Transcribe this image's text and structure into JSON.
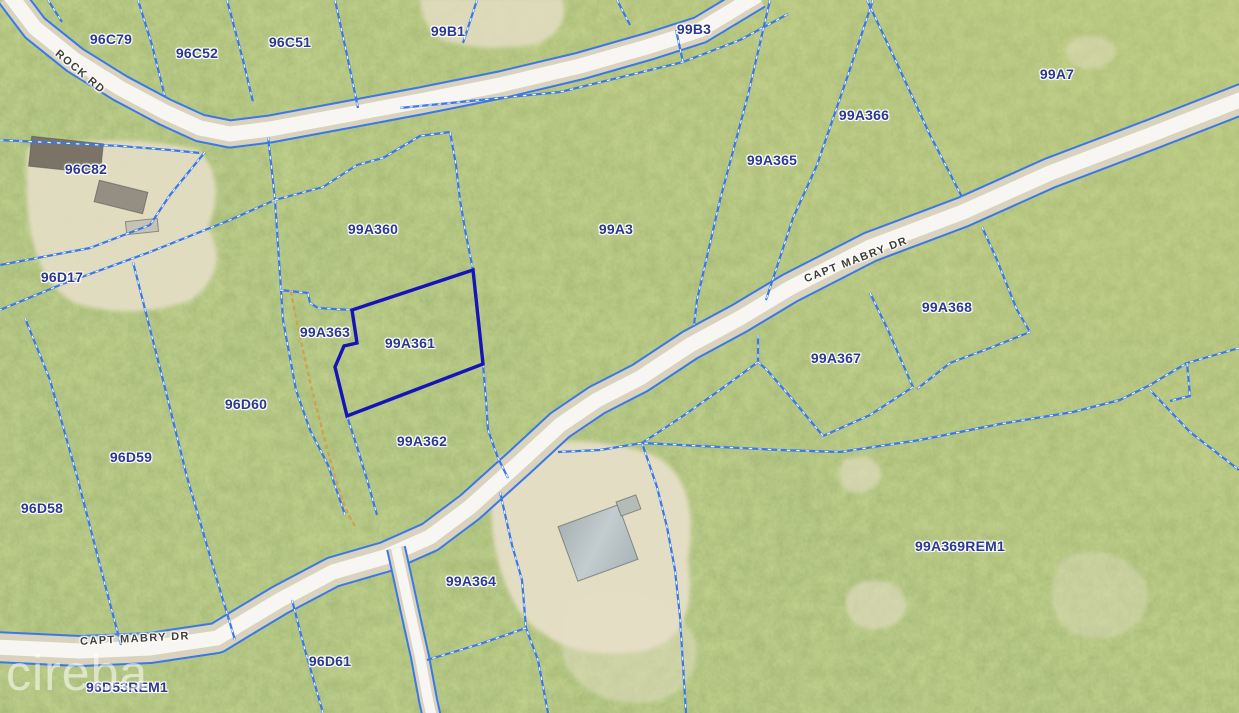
{
  "watermark": {
    "text": "cireba"
  },
  "selected_parcel": {
    "id": "99A361"
  },
  "colors": {
    "vegetation_base": "#8ca558",
    "parcel_line": "#3a78e8",
    "parcel_line_dash": "#ffffff",
    "selected_outline": "#1414b8",
    "parcel_label": "#2a3890",
    "road_label": "#3f3f38",
    "road_lane": "#f7f6f2",
    "road_shoulder": "#d9d2bd",
    "trail_dots": "#cfa252"
  },
  "parcel_labels": [
    {
      "id": "96C79",
      "x": 111,
      "y": 39
    },
    {
      "id": "96C52",
      "x": 197,
      "y": 53
    },
    {
      "id": "96C51",
      "x": 290,
      "y": 42
    },
    {
      "id": "99B1",
      "x": 448,
      "y": 31
    },
    {
      "id": "99B3",
      "x": 694,
      "y": 29
    },
    {
      "id": "99A7",
      "x": 1057,
      "y": 74
    },
    {
      "id": "99A366",
      "x": 864,
      "y": 115
    },
    {
      "id": "99A365",
      "x": 772,
      "y": 160
    },
    {
      "id": "96C82",
      "x": 86,
      "y": 169
    },
    {
      "id": "99A360",
      "x": 373,
      "y": 229
    },
    {
      "id": "99A3",
      "x": 616,
      "y": 229
    },
    {
      "id": "96D17",
      "x": 62,
      "y": 277
    },
    {
      "id": "99A363",
      "x": 325,
      "y": 332
    },
    {
      "id": "99A361",
      "x": 410,
      "y": 343
    },
    {
      "id": "99A368",
      "x": 947,
      "y": 307
    },
    {
      "id": "99A367",
      "x": 836,
      "y": 358
    },
    {
      "id": "96D60",
      "x": 246,
      "y": 404
    },
    {
      "id": "99A362",
      "x": 422,
      "y": 441
    },
    {
      "id": "96D59",
      "x": 131,
      "y": 457
    },
    {
      "id": "96D58",
      "x": 42,
      "y": 508
    },
    {
      "id": "99A369REM1",
      "x": 960,
      "y": 546
    },
    {
      "id": "99A364",
      "x": 471,
      "y": 581
    },
    {
      "id": "96D61",
      "x": 330,
      "y": 661
    },
    {
      "id": "96D53REM1",
      "x": 127,
      "y": 687
    }
  ],
  "road_labels": [
    {
      "text": "ROCK RD",
      "x": 80,
      "y": 72,
      "rot": 40
    },
    {
      "text": "CAPT MABRY DR",
      "x": 856,
      "y": 260,
      "rot": -21
    },
    {
      "text": "CAPT MABRY DR",
      "x": 135,
      "y": 639,
      "rot": -3
    }
  ],
  "geometry": {
    "selected_outline": [
      [
        473,
        270
      ],
      [
        352,
        310
      ],
      [
        357,
        343
      ],
      [
        344,
        346
      ],
      [
        335,
        367
      ],
      [
        347,
        416
      ],
      [
        483,
        364
      ]
    ],
    "trail": [
      [
        291,
        292
      ],
      [
        296,
        318
      ],
      [
        303,
        350
      ],
      [
        310,
        382
      ],
      [
        318,
        414
      ],
      [
        327,
        448
      ],
      [
        336,
        480
      ],
      [
        346,
        510
      ],
      [
        356,
        528
      ]
    ],
    "boundaries": [
      [
        [
          48,
          0
        ],
        [
          62,
          22
        ]
      ],
      [
        [
          138,
          0
        ],
        [
          152,
          45
        ],
        [
          165,
          97
        ]
      ],
      [
        [
          227,
          0
        ],
        [
          243,
          60
        ],
        [
          253,
          102
        ]
      ],
      [
        [
          335,
          0
        ],
        [
          347,
          55
        ],
        [
          358,
          108
        ]
      ],
      [
        [
          477,
          0
        ],
        [
          463,
          43
        ]
      ],
      [
        [
          617,
          0
        ],
        [
          630,
          25
        ]
      ],
      [
        [
          400,
          108
        ],
        [
          480,
          100
        ],
        [
          560,
          92
        ],
        [
          683,
          62
        ],
        [
          740,
          40
        ],
        [
          788,
          14
        ]
      ],
      [
        [
          683,
          62
        ],
        [
          676,
          30
        ]
      ],
      [
        [
          770,
          0
        ],
        [
          748,
          95
        ],
        [
          720,
          200
        ],
        [
          697,
          300
        ],
        [
          694,
          325
        ]
      ],
      [
        [
          873,
          0
        ],
        [
          848,
          75
        ],
        [
          817,
          165
        ],
        [
          793,
          218
        ],
        [
          766,
          300
        ]
      ],
      [
        [
          867,
          0
        ],
        [
          900,
          70
        ],
        [
          930,
          135
        ],
        [
          962,
          197
        ]
      ],
      [
        [
          205,
          152
        ],
        [
          170,
          195
        ],
        [
          150,
          225
        ],
        [
          90,
          248
        ],
        [
          0,
          265
        ]
      ],
      [
        [
          275,
          200
        ],
        [
          230,
          220
        ],
        [
          150,
          252
        ],
        [
          60,
          285
        ],
        [
          0,
          310
        ]
      ],
      [
        [
          268,
          137
        ],
        [
          272,
          172
        ],
        [
          275,
          200
        ]
      ],
      [
        [
          275,
          200
        ],
        [
          281,
          290
        ],
        [
          283,
          320
        ],
        [
          296,
          390
        ],
        [
          310,
          430
        ],
        [
          328,
          465
        ],
        [
          345,
          515
        ]
      ],
      [
        [
          25,
          318
        ],
        [
          50,
          380
        ],
        [
          78,
          480
        ],
        [
          103,
          577
        ],
        [
          121,
          645
        ]
      ],
      [
        [
          133,
          262
        ],
        [
          163,
          380
        ],
        [
          187,
          477
        ],
        [
          217,
          580
        ],
        [
          235,
          640
        ]
      ],
      [
        [
          0,
          140
        ],
        [
          60,
          143
        ],
        [
          120,
          146
        ],
        [
          170,
          150
        ],
        [
          200,
          153
        ]
      ],
      [
        [
          280,
          290
        ],
        [
          308,
          293
        ],
        [
          310,
          303
        ],
        [
          318,
          308
        ],
        [
          334,
          309
        ],
        [
          352,
          310
        ]
      ],
      [
        [
          347,
          416
        ],
        [
          358,
          450
        ],
        [
          368,
          483
        ],
        [
          377,
          515
        ]
      ],
      [
        [
          450,
          132
        ],
        [
          456,
          165
        ],
        [
          460,
          200
        ],
        [
          466,
          235
        ],
        [
          473,
          270
        ]
      ],
      [
        [
          483,
          364
        ],
        [
          486,
          400
        ],
        [
          488,
          430
        ],
        [
          498,
          458
        ],
        [
          508,
          478
        ]
      ],
      [
        [
          275,
          200
        ],
        [
          323,
          187
        ],
        [
          357,
          165
        ],
        [
          383,
          158
        ],
        [
          420,
          136
        ],
        [
          450,
          132
        ]
      ],
      [
        [
          758,
          335
        ],
        [
          758,
          362
        ]
      ],
      [
        [
          758,
          362
        ],
        [
          720,
          390
        ],
        [
          680,
          418
        ],
        [
          642,
          443
        ],
        [
          600,
          450
        ],
        [
          558,
          452
        ]
      ],
      [
        [
          642,
          443
        ],
        [
          657,
          487
        ],
        [
          667,
          527
        ],
        [
          675,
          570
        ],
        [
          680,
          617
        ],
        [
          686,
          713
        ]
      ],
      [
        [
          500,
          492
        ],
        [
          512,
          545
        ],
        [
          522,
          580
        ],
        [
          526,
          628
        ],
        [
          538,
          660
        ],
        [
          548,
          713
        ]
      ],
      [
        [
          526,
          628
        ],
        [
          480,
          644
        ],
        [
          427,
          660
        ]
      ],
      [
        [
          870,
          293
        ],
        [
          888,
          330
        ],
        [
          901,
          360
        ],
        [
          913,
          387
        ]
      ],
      [
        [
          913,
          387
        ],
        [
          870,
          415
        ],
        [
          823,
          436
        ]
      ],
      [
        [
          823,
          436
        ],
        [
          793,
          400
        ],
        [
          767,
          370
        ],
        [
          758,
          362
        ]
      ],
      [
        [
          982,
          227
        ],
        [
          997,
          260
        ],
        [
          1017,
          310
        ],
        [
          1030,
          332
        ]
      ],
      [
        [
          1030,
          332
        ],
        [
          990,
          348
        ],
        [
          950,
          363
        ],
        [
          917,
          389
        ]
      ],
      [
        [
          1239,
          348
        ],
        [
          1187,
          363
        ],
        [
          1150,
          385
        ],
        [
          1120,
          400
        ],
        [
          1073,
          412
        ],
        [
          1000,
          424
        ],
        [
          920,
          440
        ],
        [
          840,
          452
        ],
        [
          780,
          450
        ],
        [
          700,
          446
        ],
        [
          642,
          443
        ]
      ],
      [
        [
          1187,
          363
        ],
        [
          1190,
          396
        ],
        [
          1170,
          401
        ]
      ],
      [
        [
          1150,
          390
        ],
        [
          1190,
          432
        ],
        [
          1239,
          470
        ]
      ],
      [
        [
          292,
          600
        ],
        [
          305,
          650
        ],
        [
          323,
          713
        ]
      ]
    ],
    "roads": [
      {
        "name": "rock-rd",
        "lane": 15,
        "shoulder": 25,
        "pts": [
          [
            10,
            -5
          ],
          [
            35,
            28
          ],
          [
            75,
            60
          ],
          [
            120,
            88
          ],
          [
            165,
            112
          ],
          [
            200,
            128
          ],
          [
            230,
            134
          ],
          [
            270,
            129
          ],
          [
            340,
            116
          ],
          [
            420,
            101
          ],
          [
            500,
            85
          ],
          [
            580,
            66
          ],
          [
            650,
            46
          ],
          [
            700,
            30
          ],
          [
            758,
            -5
          ]
        ]
      },
      {
        "name": "capt-mabry-dr",
        "lane": 15,
        "shoulder": 28,
        "pts": [
          [
            1245,
            98
          ],
          [
            1150,
            135
          ],
          [
            1050,
            173
          ],
          [
            963,
            212
          ],
          [
            870,
            247
          ],
          [
            790,
            288
          ],
          [
            740,
            318
          ],
          [
            690,
            345
          ],
          [
            640,
            378
          ],
          [
            597,
            400
          ],
          [
            560,
            425
          ],
          [
            520,
            462
          ],
          [
            470,
            507
          ],
          [
            430,
            537
          ],
          [
            385,
            557
          ],
          [
            333,
            572
          ],
          [
            280,
            600
          ],
          [
            240,
            624
          ],
          [
            217,
            638
          ],
          [
            150,
            648
          ],
          [
            80,
            651
          ],
          [
            -5,
            647
          ]
        ]
      },
      {
        "name": "side-spur",
        "lane": 10,
        "shoulder": 16,
        "pts": [
          [
            396,
            548
          ],
          [
            402,
            575
          ],
          [
            410,
            612
          ],
          [
            420,
            657
          ],
          [
            428,
            700
          ],
          [
            432,
            718
          ]
        ]
      }
    ],
    "sand_patches": [
      {
        "d": "M28,148 Q120,132 198,150 Q228,178 208,228 Q232,268 192,300 Q130,322 72,302 Q18,268 28,148 Z",
        "opacity": 0.9
      },
      {
        "d": "M498,458 Q560,428 645,452 Q702,472 688,560 Q700,642 638,652 Q558,662 518,610 Q478,540 498,458 Z",
        "opacity": 0.95
      },
      {
        "d": "M420,-2 L562,-2 Q572,28 538,44 Q478,54 438,38 Q420,20 420,-2 Z",
        "opacity": 0.8
      },
      {
        "d": "M845,460 q20,-10 32,4 q10,16 -6,26 q-22,8 -30,-6 q-6,-14 4,-24 Z",
        "opacity": 0.6
      },
      {
        "d": "M855,585 q30,-12 46,6 q14,20 -8,34 q-30,12 -44,-8 q-8,-20 6,-32 Z",
        "opacity": 0.6
      },
      {
        "d": "M1060,560 q40,-18 70,5 q30,22 10,55 q-30,30 -70,12 q-30,-20 -10,-72 Z",
        "opacity": 0.4
      },
      {
        "d": "M575,600 q50,-20 90,5 q40,25 30,60 q-15,40 -60,38 q-50,-2 -70,-40 q-10,-40 10,-63 Z",
        "opacity": 0.5
      },
      {
        "d": "M1072,40 q26,-10 40,4 q10,14 -8,22 q-26,8 -36,-6 q-6,-12 4,-20 Z",
        "opacity": 0.45
      }
    ],
    "buildings": [
      {
        "x": 30,
        "y": 140,
        "w": 72,
        "h": 30,
        "rot": 6,
        "fill": "#7b7466"
      },
      {
        "x": 96,
        "y": 186,
        "w": 50,
        "h": 22,
        "rot": 14,
        "fill": "#958e82"
      },
      {
        "x": 126,
        "y": 220,
        "w": 32,
        "h": 13,
        "rot": -6,
        "fill": "#c7c2b6"
      },
      {
        "x": 566,
        "y": 514,
        "w": 64,
        "h": 58,
        "rot": -20,
        "fill": "roof-gradient"
      },
      {
        "x": 618,
        "y": 498,
        "w": 21,
        "h": 15,
        "rot": -20,
        "fill": "#b3bcb6"
      }
    ]
  }
}
